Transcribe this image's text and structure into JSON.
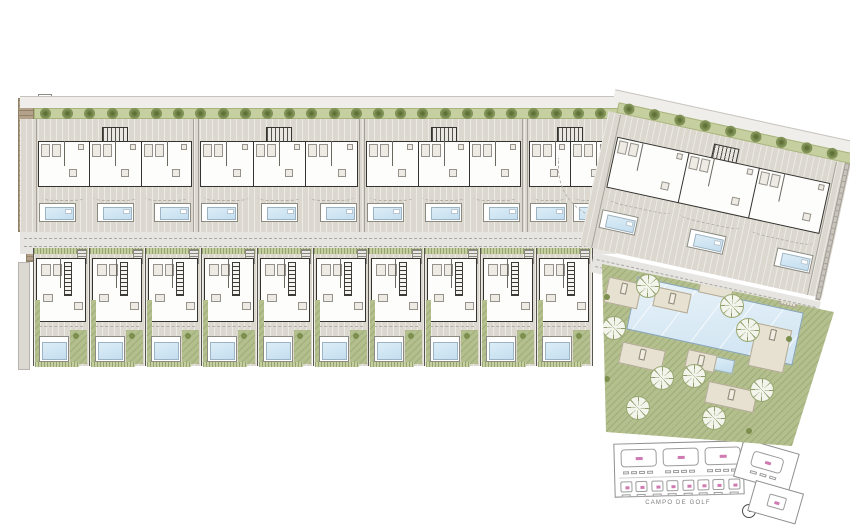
{
  "plan": {
    "colors": {
      "paved": "#dcd8d0",
      "paved_hatch": "#cfcabf",
      "hedge": "#c6cf9f",
      "hedge_border": "#a9b37c",
      "tree": "#74854a",
      "lawn": "#b3bf8d",
      "water": "#cfe4f0",
      "wall": "#35332f",
      "road": "#e7e5e1",
      "road_dash": "#aaa7a0",
      "deck": "#e7e1d2",
      "tan": "#b3a289",
      "keyline": "#8f8f8f",
      "pink": "#cf7ab1"
    },
    "top_band": {
      "hedge_trees": 26,
      "buildings": [
        {
          "x": 36,
          "w": 158,
          "units": 3
        },
        {
          "x": 198,
          "w": 162,
          "units": 3
        },
        {
          "x": 364,
          "w": 159,
          "units": 3
        },
        {
          "x": 527,
          "w": 86,
          "units": 2
        }
      ]
    },
    "bottom_band": {
      "units": 10
    },
    "wing": {
      "hedge_trees": 9,
      "building_units": 3
    },
    "communal": {
      "decks": [
        [
          10,
          30,
          34,
          26,
          4
        ],
        [
          58,
          40,
          36,
          20,
          4
        ],
        [
          156,
          76,
          36,
          44,
          6
        ],
        [
          24,
          96,
          44,
          22,
          5
        ],
        [
          90,
          102,
          30,
          18,
          3
        ],
        [
          110,
          136,
          50,
          22,
          5
        ]
      ],
      "trees": [
        [
          52,
          36
        ],
        [
          136,
          56
        ],
        [
          152,
          80
        ],
        [
          18,
          78
        ],
        [
          66,
          128
        ],
        [
          98,
          126
        ],
        [
          166,
          140
        ],
        [
          118,
          168
        ],
        [
          42,
          158
        ]
      ],
      "shrubs": [
        [
          8,
          44
        ],
        [
          8,
          126
        ],
        [
          190,
          86
        ],
        [
          150,
          178
        ]
      ]
    },
    "key_plan": {
      "campo_label": "CAMPO DE GOLF",
      "north_label": "N",
      "large_units": 3,
      "small_units": 8
    }
  }
}
